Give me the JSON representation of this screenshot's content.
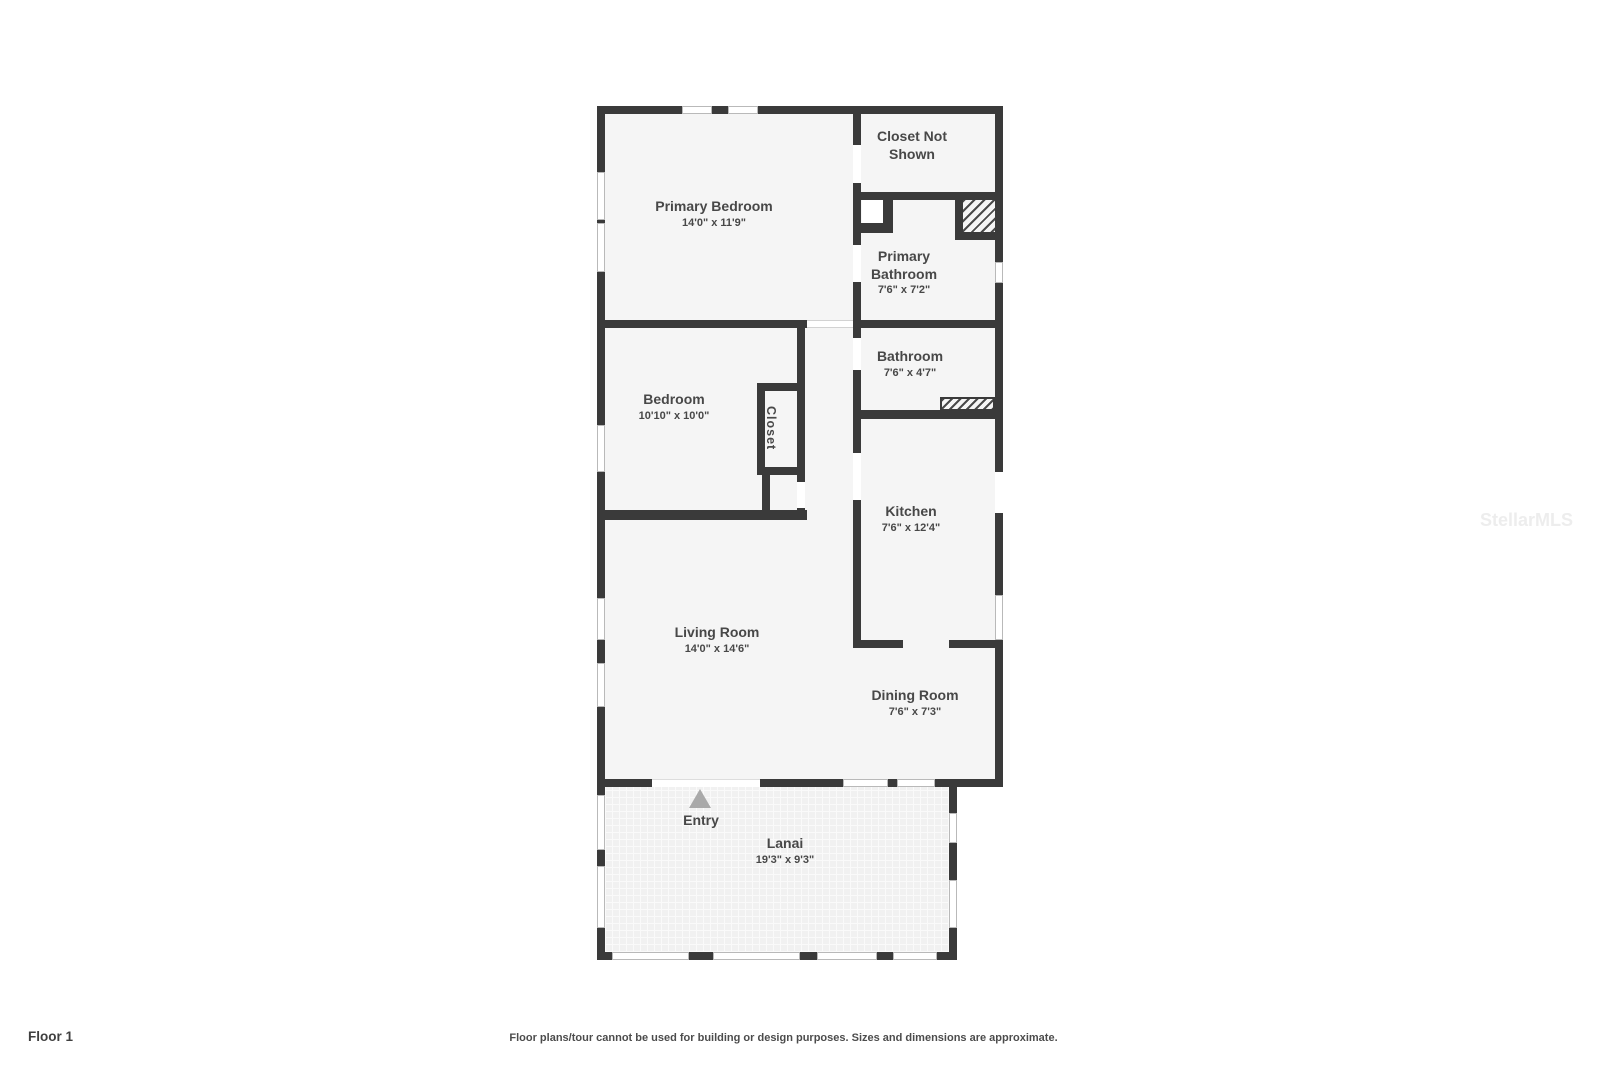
{
  "page": {
    "floor_label": "Floor 1",
    "disclaimer": "Floor plans/tour cannot be used for building or design purposes. Sizes and dimensions are approximate.",
    "watermark": "StellarMLS"
  },
  "colors": {
    "wall": "#3a3a3a",
    "room_fill": "#f5f5f5",
    "label_text": "#484848",
    "entry_arrow": "#a9a9a9"
  },
  "rooms": {
    "primary_bedroom": {
      "name": "Primary Bedroom",
      "dims": "14'0\" x 11'9\""
    },
    "closet_not_shown": {
      "name": "Closet Not Shown"
    },
    "primary_bathroom": {
      "name": "Primary Bathroom",
      "dims": "7'6\" x 7'2\""
    },
    "bathroom": {
      "name": "Bathroom",
      "dims": "7'6\" x 4'7\""
    },
    "bedroom": {
      "name": "Bedroom",
      "dims": "10'10\" x 10'0\""
    },
    "closet": {
      "name": "Closet"
    },
    "kitchen": {
      "name": "Kitchen",
      "dims": "7'6\" x 12'4\""
    },
    "living_room": {
      "name": "Living Room",
      "dims": "14'0\" x 14'6\""
    },
    "dining_room": {
      "name": "Dining Room",
      "dims": "7'6\" x 7'3\""
    },
    "entry": {
      "name": "Entry"
    },
    "lanai": {
      "name": "Lanai",
      "dims": "19'3\" x 9'3\""
    }
  }
}
